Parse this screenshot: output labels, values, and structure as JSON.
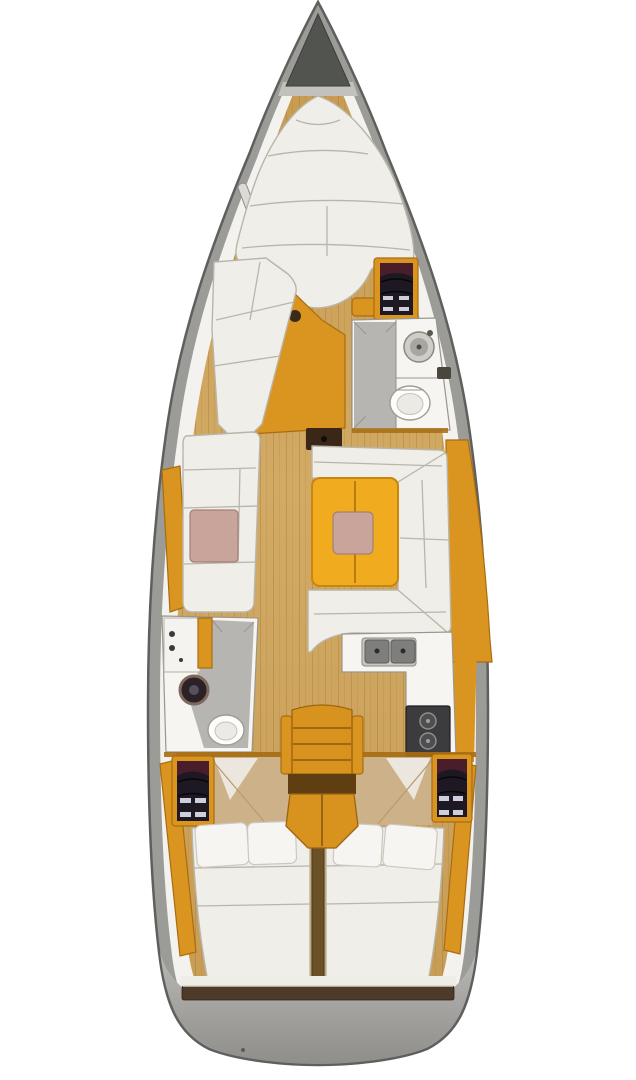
{
  "scene": {
    "type": "sailboat-interior-floor-plan",
    "view": "top-down",
    "orientation": "bow-up",
    "description": "Top-down interior floor plan of a sailing yacht: V-berth forward, forward head, saloon with U-shaped dinette and table, galley, aft head, companionway steps and twin aft double cabins"
  },
  "colors": {
    "hull_edge": "#5f5f5d",
    "hull_deck": "#9b9b98",
    "hull_deck_light": "#c3c1bb",
    "side_deck": "#f3f2ee",
    "anchor_locker": "#51544f",
    "floor_wood": "#cda45e",
    "cabinet_wood": "#d9951f",
    "cabinet_wood_dark": "#a86d12",
    "table_wood": "#f0ab1e",
    "upholstery": "#f0eee8",
    "seam": "#b9b5aa",
    "cushion_pink": "#c8a49b",
    "shower_floor": "#b6b5b1",
    "fixture_white": "#f6f5f2",
    "fixture_line": "#9a968c",
    "dark_locker_shelf": "#1e1822",
    "shelf_maroon": "#4a1d2a",
    "shelf_stripe": "#cdd0dc",
    "appliance_dark": "#3c3c3e",
    "appliance_mid": "#7e7e7c",
    "door_dark": "#3a2717",
    "steps_wood": "#d8921e",
    "transom_wood": "#4e3a28",
    "stern_deck_light": "#b4b3af",
    "stern_deck_dark": "#8f8e8a"
  },
  "features": [
    "bow-anchor-locker",
    "v-berth",
    "hull-window-port",
    "hull-window-starboard",
    "forward-chaise-sofa",
    "forward-storage-shelves",
    "forward-head-shower",
    "forward-head-sink",
    "forward-head-toilet",
    "cabin-door-opening",
    "port-settee",
    "dinette-u-settee",
    "saloon-table",
    "galley-counter",
    "galley-double-sink",
    "galley-stove",
    "aft-head-shower",
    "aft-head-round-sink",
    "aft-head-toilet",
    "companionway-steps",
    "aft-storage-shelves-port",
    "aft-storage-shelves-starboard",
    "port-aft-berth",
    "starboard-aft-berth",
    "transom-step"
  ]
}
